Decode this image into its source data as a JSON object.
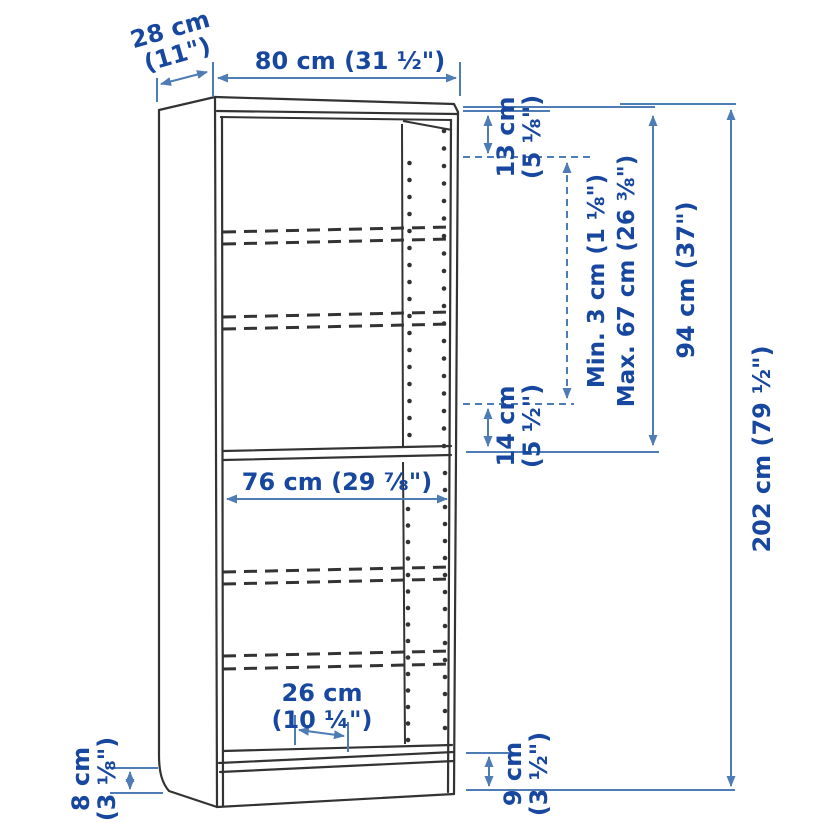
{
  "colors": {
    "background": "#ffffff",
    "furniture_line": "#333333",
    "dimension_line": "#4E7CB4",
    "dimension_text": "#17479E"
  },
  "diagram": {
    "type": "furniture-dimension-diagram",
    "subject": "bookcase",
    "dimensions": {
      "depth": {
        "line1": "28 cm",
        "line2": "(11\")"
      },
      "width": {
        "label": "80 cm (31 ½\")"
      },
      "top_offset": {
        "line1": "13 cm",
        "line2": "(5 ⅛\")"
      },
      "shelf_adjust": {
        "line1": "Min. 3 cm (1 ⅛\")",
        "line2": "Max. 67 cm (26 ⅜\")"
      },
      "upper_section": {
        "label": "94 cm (37\")"
      },
      "total_height": {
        "label": "202 cm (79 ½\")"
      },
      "above_fixed_shelf": {
        "line1": "14 cm",
        "line2": "(5 ½\")"
      },
      "inner_width": {
        "label": "76 cm (29 ⅞\")"
      },
      "shelf_depth": {
        "line1": "26 cm",
        "line2": "(10 ¼\")"
      },
      "base_rear_height": {
        "line1": "8 cm",
        "line2": "(3 ⅛\")"
      },
      "base_front_height": {
        "line1": "9 cm",
        "line2": "(3 ½\")"
      }
    }
  }
}
